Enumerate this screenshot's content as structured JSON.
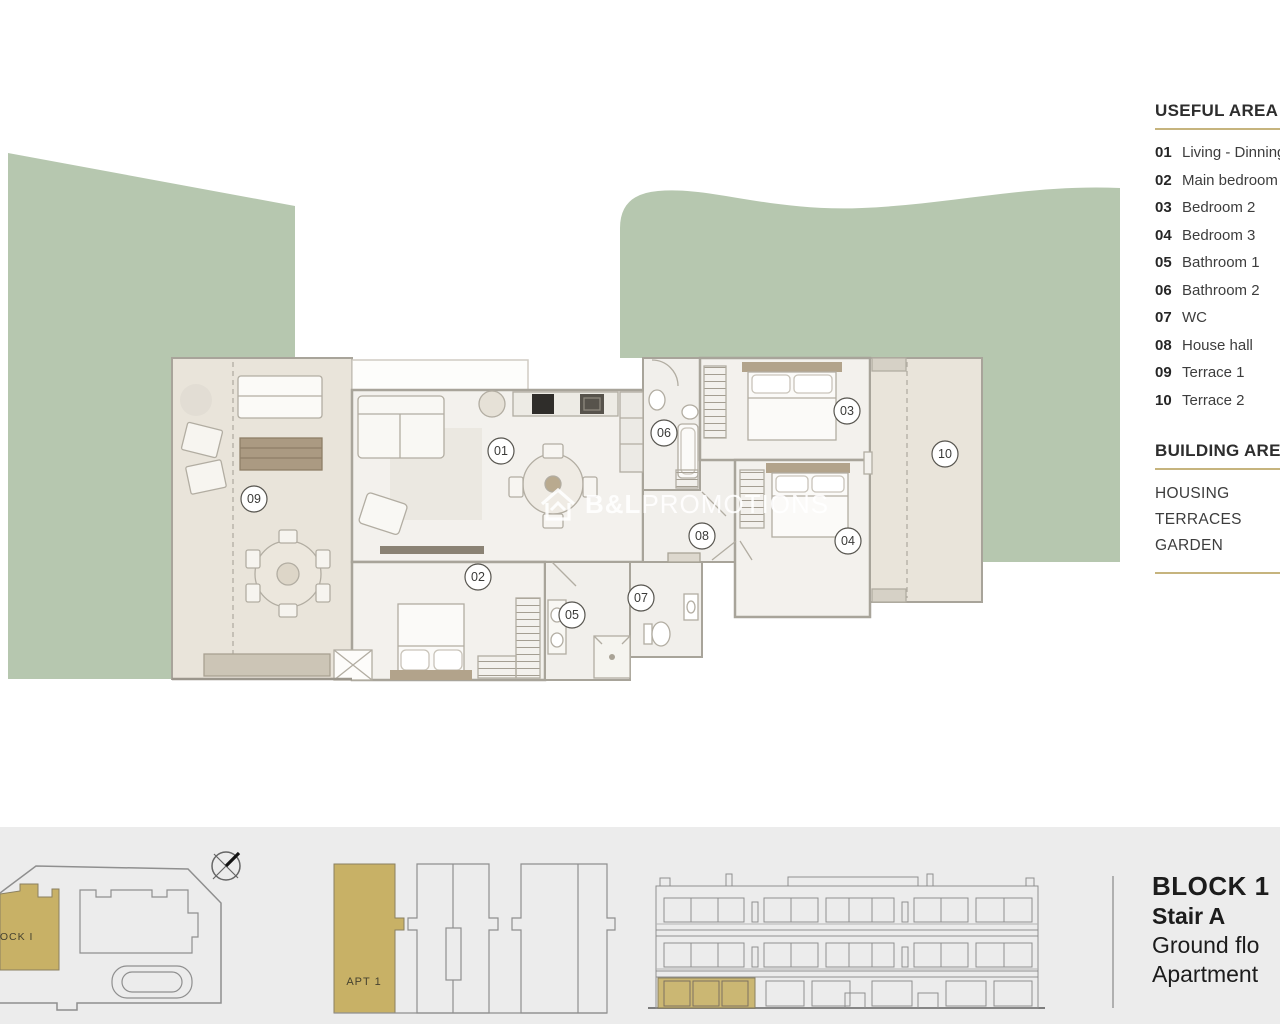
{
  "colors": {
    "garden_green": "#b6c7af",
    "terrace_beige": "#e9e4da",
    "floor_light": "#f3f1ed",
    "highlight_gold": "#c8b166",
    "accent_line_gold": "#c6b47e",
    "footer_bg": "#ececec",
    "wall_gray": "#a8a49a",
    "text_dark": "#2d2d2d"
  },
  "legend": {
    "title": "USEFUL AREA",
    "items": [
      {
        "num": "01",
        "label": "Living - Dinning"
      },
      {
        "num": "02",
        "label": "Main bedroom"
      },
      {
        "num": "03",
        "label": "Bedroom 2"
      },
      {
        "num": "04",
        "label": "Bedroom 3"
      },
      {
        "num": "05",
        "label": "Bathroom 1"
      },
      {
        "num": "06",
        "label": "Bathroom 2"
      },
      {
        "num": "07",
        "label": "WC"
      },
      {
        "num": "08",
        "label": "House hall"
      },
      {
        "num": "09",
        "label": "Terrace 1"
      },
      {
        "num": "10",
        "label": "Terrace 2"
      }
    ]
  },
  "building_area": {
    "title": "BUILDING AREA",
    "items": [
      "HOUSING",
      "TERRACES",
      "GARDEN"
    ]
  },
  "plan": {
    "labels": [
      "01",
      "02",
      "03",
      "04",
      "05",
      "06",
      "07",
      "08",
      "09",
      "10"
    ]
  },
  "watermark": {
    "brand_bold": "B&L",
    "brand_rest": "PROMOTIONS"
  },
  "footer": {
    "site_block_label": "BLOCK I",
    "apartment_key_label": "APT 1",
    "title": "BLOCK 1",
    "stair": "Stair A",
    "floor": "Ground flo",
    "apartment": "Apartment"
  }
}
